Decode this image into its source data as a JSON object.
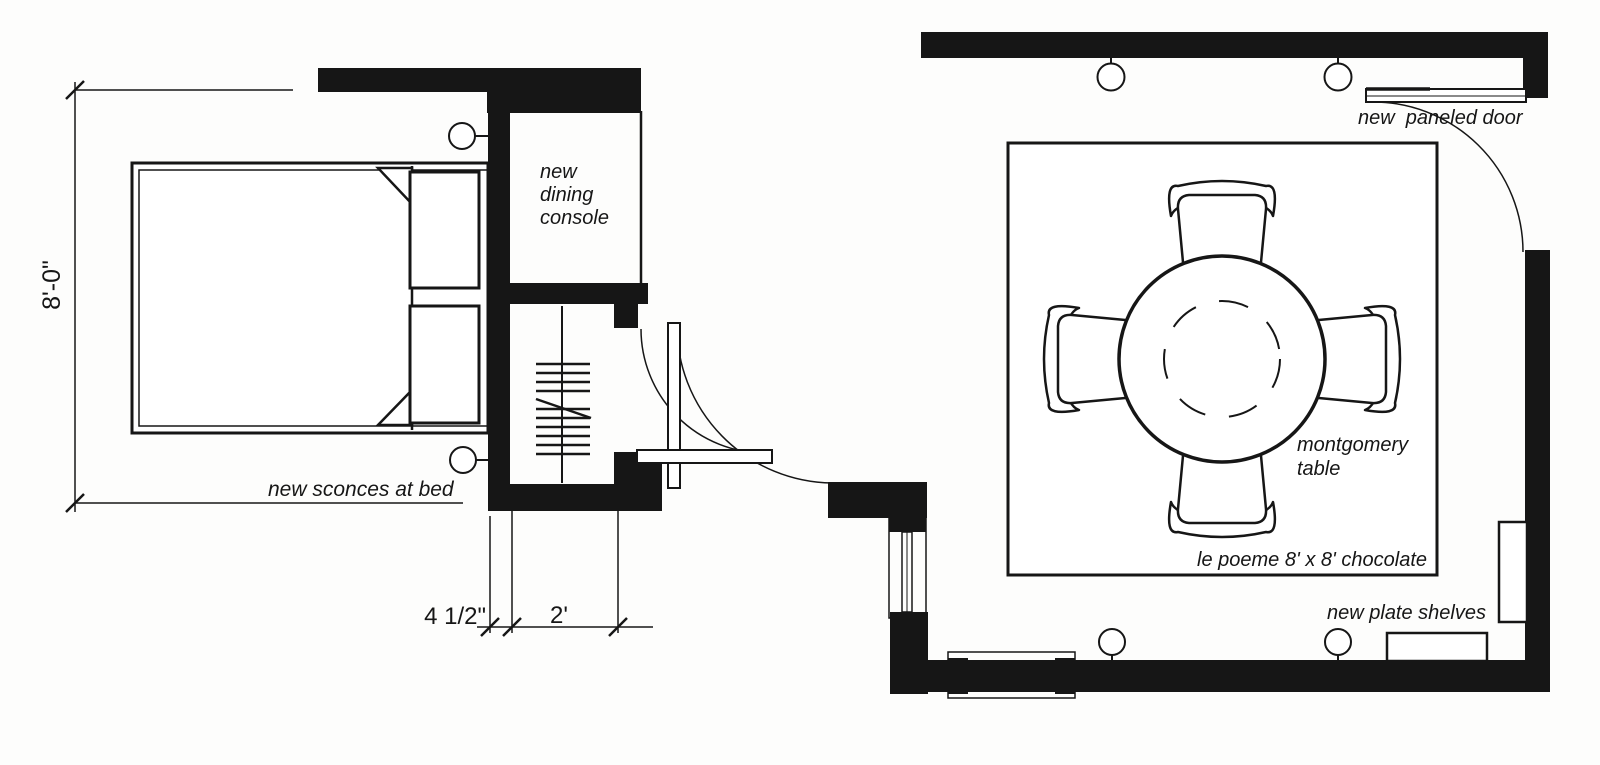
{
  "plan": {
    "labels": {
      "dining_console_1": "new",
      "dining_console_2": "dining",
      "dining_console_3": "console",
      "sconces": "new sconces at bed",
      "paneled_door": "new  paneled door",
      "table_1": "montgomery",
      "table_2": "table",
      "rug": "le poeme 8' x 8' chocolate",
      "plate_shelves": "new plate shelves"
    },
    "dimensions": {
      "bedroom_width": "8'-0\"",
      "wall_offset": "4 1/2\"",
      "closet_depth": "2'"
    },
    "colors": {
      "ink": "#161616",
      "paper": "#fdfdfc"
    }
  }
}
